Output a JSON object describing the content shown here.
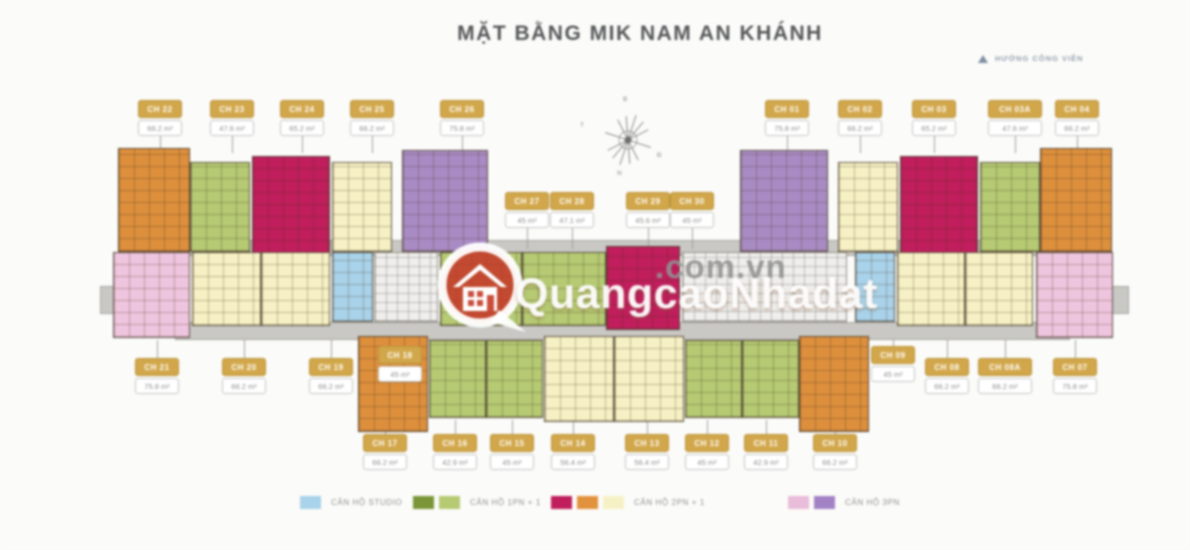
{
  "title": "MẶT BẰNG MIK NAM AN KHÁNH",
  "park_note": {
    "label": "HƯỚNG CÔNG VIÊN"
  },
  "compass": {
    "north": "B",
    "south": "N",
    "east": "Đ",
    "west": "T"
  },
  "watermark": {
    "brand": "QuangcaoNhadat",
    "domain": ".com.vn"
  },
  "legend": {
    "items": [
      {
        "label": "CĂN HỘ STUDIO",
        "colors": [
          "#a9d3ea"
        ]
      },
      {
        "label": "CĂN HỘ 1PN + 1",
        "colors": [
          "#7a9638",
          "#b5ca73"
        ]
      },
      {
        "label": "CĂN HỘ 2PN + 1",
        "colors": [
          "#c01e5c",
          "#e2923c",
          "#f6f1c4"
        ]
      },
      {
        "label": "CĂN HỘ 3PN",
        "colors": [
          "#e9bcd9",
          "#a282c5"
        ]
      }
    ]
  },
  "colors": {
    "orange": "#dd8f3c",
    "green": "#b5ca73",
    "magenta": "#c01e5c",
    "cream": "#f6f1c4",
    "purple": "#a98bc4",
    "pink": "#eec5de",
    "blue": "#a9d3ea",
    "corridor": "#c9c8c4",
    "core": "#f0efec",
    "label_gold": "#d2a74b"
  },
  "unit_labels": {
    "top_left": [
      {
        "id": "CH 22",
        "area": "66.2 m²"
      },
      {
        "id": "CH 23",
        "area": "47.6 m²"
      },
      {
        "id": "CH 24",
        "area": "65.2 m²"
      },
      {
        "id": "CH 25",
        "area": "66.2 m²"
      },
      {
        "id": "CH 26",
        "area": "75.8 m²"
      }
    ],
    "top_right": [
      {
        "id": "CH 01",
        "area": "75.8 m²"
      },
      {
        "id": "CH 02",
        "area": "66.2 m²"
      },
      {
        "id": "CH 03",
        "area": "65.2 m²"
      },
      {
        "id": "CH 03A",
        "area": "47.6 m²"
      },
      {
        "id": "CH 04",
        "area": "66.2 m²"
      }
    ],
    "middle": [
      {
        "id": "CH 27",
        "area": "45 m²"
      },
      {
        "id": "CH 28",
        "area": "47.1 m²"
      },
      {
        "id": "CH 29",
        "area": "45.6 m²"
      },
      {
        "id": "CH 30",
        "area": "45 m²"
      }
    ],
    "bottom_left": [
      {
        "id": "CH 21",
        "area": "75.8 m²"
      },
      {
        "id": "CH 20",
        "area": "66.2 m²"
      },
      {
        "id": "CH 19",
        "area": "66.2 m²"
      },
      {
        "id": "CH 18",
        "area": "45 m²"
      }
    ],
    "bottom_center": [
      {
        "id": "CH 17",
        "area": "66.2 m²"
      },
      {
        "id": "CH 16",
        "area": "42.9 m²"
      },
      {
        "id": "CH 15",
        "area": "45 m²"
      },
      {
        "id": "CH 14",
        "area": "56.4 m²"
      },
      {
        "id": "CH 13",
        "area": "56.4 m²"
      },
      {
        "id": "CH 12",
        "area": "45 m²"
      },
      {
        "id": "CH 11",
        "area": "42.9 m²"
      },
      {
        "id": "CH 10",
        "area": "66.2 m²"
      }
    ],
    "bottom_right": [
      {
        "id": "CH 09",
        "area": "45 m²"
      },
      {
        "id": "CH 08",
        "area": "66.2 m²"
      },
      {
        "id": "CH 08A",
        "area": "66.2 m²"
      },
      {
        "id": "CH 07",
        "area": "75.8 m²"
      }
    ]
  }
}
